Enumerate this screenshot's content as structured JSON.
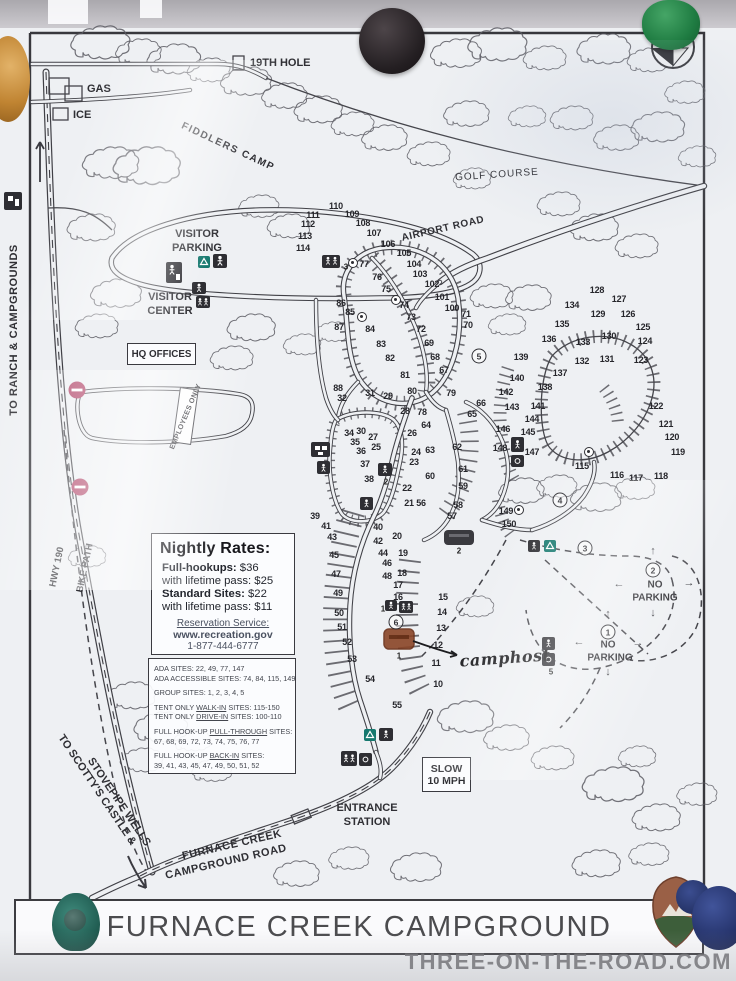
{
  "photo": {
    "watermark": "THREE-ON-THE-ROAD.COM",
    "pins": [
      {
        "id": "orange-pin-top-left",
        "color": "#c08432"
      },
      {
        "id": "black-magnet-top-center",
        "color": "#241f22"
      },
      {
        "id": "green-pin-top-right",
        "color": "#1f7c42"
      },
      {
        "id": "teal-pin-bottom-left",
        "color": "#225f54"
      },
      {
        "id": "blue-pin-bottom-right",
        "color": "#25336b"
      },
      {
        "id": "nps-arrowhead-sticker",
        "color": "#8a5a40"
      }
    ]
  },
  "map": {
    "title": "FURNACE CREEK CAMPGROUND",
    "labels": {
      "to_ranch": "TO RANCH & CAMPGROUNDS",
      "gas": "GAS",
      "ice": "ICE",
      "hole19": "19TH HOLE",
      "fiddlers_camp": "FIDDLERS CAMP",
      "golf_course": "GOLF COURSE",
      "airport_road": "AIRPORT ROAD",
      "visitor_parking": [
        "VISITOR",
        "PARKING"
      ],
      "visitor_center": [
        "VISITOR",
        "CENTER"
      ],
      "hq_offices": "HQ OFFICES",
      "employees_only": "EMPLOYEES ONLY",
      "hwy_190": "HWY 190",
      "bike_path": "BIKE PATH",
      "no_parking": [
        "NO",
        "PARKING"
      ],
      "slow": [
        "SLOW",
        "10 MPH"
      ],
      "entrance": [
        "ENTRANCE",
        "STATION"
      ],
      "fc_road": [
        "FURNACE CREEK",
        "CAMPGROUND ROAD"
      ],
      "scottys": [
        "TO SCOTTY'S CASTLE &",
        "STOVEPIPE WELLS"
      ],
      "camphost": "camphost"
    },
    "rates_box": {
      "title": "Nightly Rates:",
      "lines": [
        {
          "b": "Full-hookups:",
          "r": " $36"
        },
        {
          "b": "",
          "r": "with lifetime pass: $25"
        },
        {
          "b": "Standard Sites:",
          "r": " $22"
        },
        {
          "b": "",
          "r": "with lifetime pass: $11"
        }
      ],
      "reservation": [
        "Reservation Service:",
        "www.recreation.gov",
        "1-877-444-6777"
      ]
    },
    "site_info_box": {
      "lines": [
        {
          "pre": "ADA SITES: 22, 49, 77, 147",
          "u": "",
          "post": ""
        },
        {
          "pre": "ADA ACCESSIBLE SITES: 74, 84, 115, 149",
          "u": "",
          "post": ""
        },
        {
          "pre": "GROUP SITES: 1, 2, 3, 4, 5",
          "u": "",
          "post": ""
        },
        {
          "pre": "TENT ONLY ",
          "u": "WALK-IN",
          "post": " SITES: 115-150"
        },
        {
          "pre": "TENT ONLY ",
          "u": "DRIVE-IN",
          "post": " SITES: 100-110"
        },
        {
          "pre": "FULL HOOK-UP ",
          "u": "PULL-THROUGH",
          "post": " SITES:"
        },
        {
          "pre": "67, 68, 69, 72, 73, 74, 75, 76, 77",
          "u": "",
          "post": ""
        },
        {
          "pre": "FULL HOOK-UP ",
          "u": "BACK-IN",
          "post": " SITES:"
        },
        {
          "pre": "39, 41, 43, 45, 47, 49, 50, 51, 52",
          "u": "",
          "post": ""
        }
      ]
    },
    "sites": [
      {
        "n": "110",
        "x": 336,
        "y": 206
      },
      {
        "n": "109",
        "x": 352,
        "y": 214
      },
      {
        "n": "111",
        "x": 313,
        "y": 215
      },
      {
        "n": "108",
        "x": 363,
        "y": 223
      },
      {
        "n": "112",
        "x": 308,
        "y": 224
      },
      {
        "n": "107",
        "x": 374,
        "y": 233
      },
      {
        "n": "113",
        "x": 305,
        "y": 236
      },
      {
        "n": "106",
        "x": 388,
        "y": 244
      },
      {
        "n": "114",
        "x": 303,
        "y": 248
      },
      {
        "n": "105",
        "x": 404,
        "y": 253
      },
      {
        "n": "104",
        "x": 414,
        "y": 264
      },
      {
        "n": "103",
        "x": 420,
        "y": 274
      },
      {
        "n": "102",
        "x": 432,
        "y": 284
      },
      {
        "n": "101",
        "x": 442,
        "y": 297
      },
      {
        "n": "100",
        "x": 452,
        "y": 308
      },
      {
        "n": "71",
        "x": 466,
        "y": 314
      },
      {
        "n": "70",
        "x": 468,
        "y": 325
      },
      {
        "n": "77",
        "x": 364,
        "y": 264
      },
      {
        "n": "76",
        "x": 377,
        "y": 277
      },
      {
        "n": "75",
        "x": 386,
        "y": 289
      },
      {
        "n": "74",
        "x": 404,
        "y": 305
      },
      {
        "n": "73",
        "x": 411,
        "y": 317
      },
      {
        "n": "72",
        "x": 421,
        "y": 329
      },
      {
        "n": "69",
        "x": 429,
        "y": 343
      },
      {
        "n": "68",
        "x": 435,
        "y": 357
      },
      {
        "n": "67",
        "x": 444,
        "y": 370
      },
      {
        "n": "86",
        "x": 341,
        "y": 303
      },
      {
        "n": "85",
        "x": 350,
        "y": 312
      },
      {
        "n": "87",
        "x": 339,
        "y": 327
      },
      {
        "n": "84",
        "x": 370,
        "y": 329
      },
      {
        "n": "83",
        "x": 381,
        "y": 344
      },
      {
        "n": "82",
        "x": 390,
        "y": 358
      },
      {
        "n": "81",
        "x": 405,
        "y": 375
      },
      {
        "n": "80",
        "x": 412,
        "y": 391
      },
      {
        "n": "88",
        "x": 338,
        "y": 388
      },
      {
        "n": "32",
        "x": 342,
        "y": 398
      },
      {
        "n": "31",
        "x": 370,
        "y": 393
      },
      {
        "n": "29",
        "x": 388,
        "y": 396
      },
      {
        "n": "28",
        "x": 405,
        "y": 411
      },
      {
        "n": "78",
        "x": 422,
        "y": 412
      },
      {
        "n": "79",
        "x": 451,
        "y": 393
      },
      {
        "n": "66",
        "x": 481,
        "y": 403
      },
      {
        "n": "65",
        "x": 472,
        "y": 414
      },
      {
        "n": "64",
        "x": 426,
        "y": 425
      },
      {
        "n": "63",
        "x": 430,
        "y": 450
      },
      {
        "n": "62",
        "x": 457,
        "y": 447
      },
      {
        "n": "26",
        "x": 412,
        "y": 433
      },
      {
        "n": "27",
        "x": 373,
        "y": 437
      },
      {
        "n": "30",
        "x": 361,
        "y": 431
      },
      {
        "n": "34",
        "x": 349,
        "y": 433
      },
      {
        "n": "35",
        "x": 355,
        "y": 442
      },
      {
        "n": "36",
        "x": 361,
        "y": 451
      },
      {
        "n": "25",
        "x": 376,
        "y": 447
      },
      {
        "n": "24",
        "x": 416,
        "y": 452
      },
      {
        "n": "23",
        "x": 414,
        "y": 462
      },
      {
        "n": "37",
        "x": 365,
        "y": 464
      },
      {
        "n": "61",
        "x": 463,
        "y": 469
      },
      {
        "n": "60",
        "x": 430,
        "y": 476
      },
      {
        "n": "38",
        "x": 369,
        "y": 479
      },
      {
        "n": "22",
        "x": 407,
        "y": 488
      },
      {
        "n": "59",
        "x": 463,
        "y": 486
      },
      {
        "n": "21",
        "x": 409,
        "y": 503
      },
      {
        "n": "56",
        "x": 421,
        "y": 503
      },
      {
        "n": "58",
        "x": 458,
        "y": 505
      },
      {
        "n": "57",
        "x": 452,
        "y": 516
      },
      {
        "n": "39",
        "x": 315,
        "y": 516
      },
      {
        "n": "40",
        "x": 378,
        "y": 527
      },
      {
        "n": "41",
        "x": 326,
        "y": 526
      },
      {
        "n": "42",
        "x": 378,
        "y": 541
      },
      {
        "n": "43",
        "x": 332,
        "y": 537
      },
      {
        "n": "44",
        "x": 383,
        "y": 553
      },
      {
        "n": "45",
        "x": 334,
        "y": 555
      },
      {
        "n": "46",
        "x": 387,
        "y": 563
      },
      {
        "n": "47",
        "x": 336,
        "y": 574
      },
      {
        "n": "48",
        "x": 387,
        "y": 576
      },
      {
        "n": "49",
        "x": 338,
        "y": 593
      },
      {
        "n": "50",
        "x": 339,
        "y": 613
      },
      {
        "n": "51",
        "x": 342,
        "y": 627
      },
      {
        "n": "52",
        "x": 347,
        "y": 642
      },
      {
        "n": "53",
        "x": 352,
        "y": 659
      },
      {
        "n": "54",
        "x": 370,
        "y": 679
      },
      {
        "n": "55",
        "x": 397,
        "y": 705
      },
      {
        "n": "20",
        "x": 397,
        "y": 536
      },
      {
        "n": "19",
        "x": 403,
        "y": 553
      },
      {
        "n": "18",
        "x": 402,
        "y": 573
      },
      {
        "n": "17",
        "x": 398,
        "y": 585
      },
      {
        "n": "16",
        "x": 398,
        "y": 597
      },
      {
        "n": "15",
        "x": 443,
        "y": 597
      },
      {
        "n": "14",
        "x": 442,
        "y": 612
      },
      {
        "n": "13",
        "x": 441,
        "y": 628
      },
      {
        "n": "12",
        "x": 438,
        "y": 645
      },
      {
        "n": "11",
        "x": 436,
        "y": 663
      },
      {
        "n": "10",
        "x": 438,
        "y": 684
      },
      {
        "n": "128",
        "x": 597,
        "y": 290
      },
      {
        "n": "127",
        "x": 619,
        "y": 299
      },
      {
        "n": "134",
        "x": 572,
        "y": 305
      },
      {
        "n": "129",
        "x": 598,
        "y": 314
      },
      {
        "n": "126",
        "x": 628,
        "y": 314
      },
      {
        "n": "135",
        "x": 562,
        "y": 324
      },
      {
        "n": "125",
        "x": 643,
        "y": 327
      },
      {
        "n": "136",
        "x": 549,
        "y": 339
      },
      {
        "n": "133",
        "x": 583,
        "y": 342
      },
      {
        "n": "130",
        "x": 609,
        "y": 336
      },
      {
        "n": "124",
        "x": 645,
        "y": 341
      },
      {
        "n": "139",
        "x": 521,
        "y": 357
      },
      {
        "n": "132",
        "x": 582,
        "y": 361
      },
      {
        "n": "131",
        "x": 607,
        "y": 359
      },
      {
        "n": "123",
        "x": 641,
        "y": 360
      },
      {
        "n": "137",
        "x": 560,
        "y": 373
      },
      {
        "n": "140",
        "x": 517,
        "y": 378
      },
      {
        "n": "138",
        "x": 545,
        "y": 387
      },
      {
        "n": "142",
        "x": 506,
        "y": 392
      },
      {
        "n": "141",
        "x": 538,
        "y": 406
      },
      {
        "n": "143",
        "x": 512,
        "y": 407
      },
      {
        "n": "122",
        "x": 656,
        "y": 406
      },
      {
        "n": "144",
        "x": 532,
        "y": 419
      },
      {
        "n": "121",
        "x": 666,
        "y": 424
      },
      {
        "n": "146",
        "x": 503,
        "y": 429
      },
      {
        "n": "145",
        "x": 528,
        "y": 432
      },
      {
        "n": "120",
        "x": 672,
        "y": 437
      },
      {
        "n": "148",
        "x": 500,
        "y": 448
      },
      {
        "n": "147",
        "x": 532,
        "y": 452
      },
      {
        "n": "119",
        "x": 678,
        "y": 452
      },
      {
        "n": "115",
        "x": 582,
        "y": 466
      },
      {
        "n": "116",
        "x": 617,
        "y": 475
      },
      {
        "n": "117",
        "x": 636,
        "y": 478
      },
      {
        "n": "118",
        "x": 661,
        "y": 476
      },
      {
        "n": "149",
        "x": 506,
        "y": 511
      },
      {
        "n": "150",
        "x": 509,
        "y": 524
      }
    ],
    "circled": [
      {
        "n": "1",
        "x": 608,
        "y": 632
      },
      {
        "n": "2",
        "x": 653,
        "y": 570
      },
      {
        "n": "3",
        "x": 585,
        "y": 548
      },
      {
        "n": "4",
        "x": 560,
        "y": 500
      },
      {
        "n": "5",
        "x": 479,
        "y": 356
      },
      {
        "n": "6",
        "x": 396,
        "y": 622
      }
    ],
    "icon_labels": [
      {
        "t": "3",
        "x": 346,
        "y": 267
      },
      {
        "t": "2",
        "x": 386,
        "y": 482
      },
      {
        "t": "2",
        "x": 459,
        "y": 551
      },
      {
        "t": "1",
        "x": 383,
        "y": 609
      },
      {
        "t": "1",
        "x": 399,
        "y": 656
      },
      {
        "t": "5",
        "x": 551,
        "y": 672
      }
    ],
    "ada_markers": [
      {
        "x": 353,
        "y": 263
      },
      {
        "x": 396,
        "y": 300
      },
      {
        "x": 362,
        "y": 317
      },
      {
        "x": 589,
        "y": 452
      },
      {
        "x": 519,
        "y": 510
      }
    ],
    "np_arrows": [
      {
        "t": "←",
        "x": 579,
        "y": 642
      },
      {
        "t": "→",
        "x": 638,
        "y": 643
      },
      {
        "t": "↑",
        "x": 608,
        "y": 614
      },
      {
        "t": "↓",
        "x": 608,
        "y": 672
      },
      {
        "t": "←",
        "x": 619,
        "y": 584
      },
      {
        "t": "→",
        "x": 689,
        "y": 583
      },
      {
        "t": "↓",
        "x": 653,
        "y": 613
      },
      {
        "t": "↑",
        "x": 653,
        "y": 551
      }
    ]
  }
}
